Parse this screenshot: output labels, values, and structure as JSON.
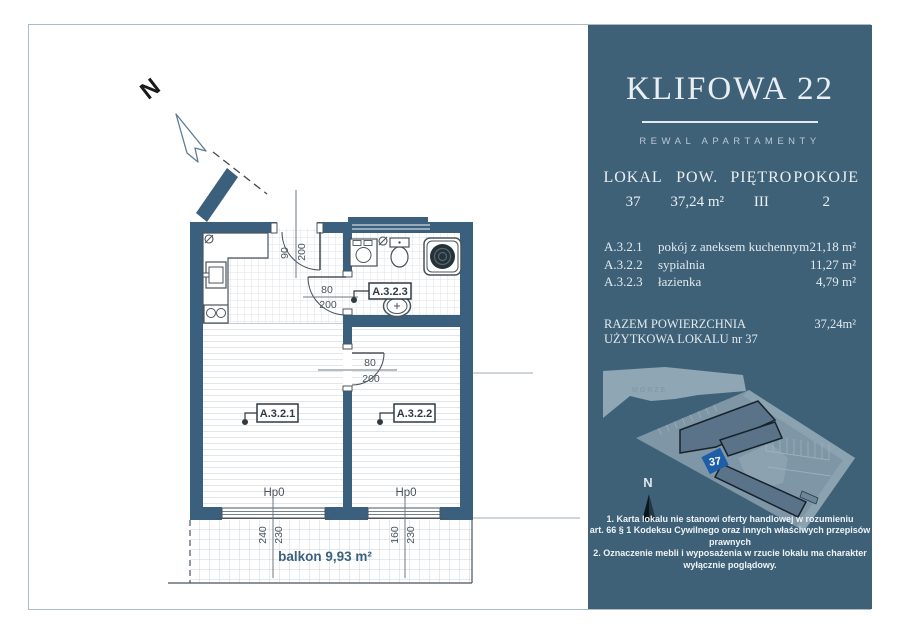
{
  "plan": {
    "north_label": "N",
    "entry_door": {
      "w": "90",
      "h": "200"
    },
    "bathroom_door": {
      "w": "80",
      "h": "200"
    },
    "bedroom_door": {
      "w": "80",
      "h": "200"
    },
    "room_tags": {
      "living": "A.3.2.1",
      "bedroom": "A.3.2.2",
      "bathroom": "A.3.2.3"
    },
    "window_left": {
      "sill": "Hp0",
      "w": "240",
      "h": "230"
    },
    "window_right": {
      "sill": "Hp0",
      "w": "160",
      "h": "230"
    },
    "balcony_label": "balkon 9,93 m²"
  },
  "panel": {
    "title": "KLIFOWA 22",
    "subtitle": "REWAL APARTAMENTY",
    "summary": [
      {
        "label": "LOKAL",
        "value": "37"
      },
      {
        "label": "POW.",
        "value": "37,24 m²"
      },
      {
        "label": "PIĘTRO",
        "value": "III"
      },
      {
        "label": "POKOJE",
        "value": "2"
      }
    ],
    "rooms": [
      {
        "code": "A.3.2.1",
        "name": "pokój z aneksem kuchennym",
        "area": "21,18 m²"
      },
      {
        "code": "A.3.2.2",
        "name": "sypialnia",
        "area": "11,27 m²"
      },
      {
        "code": "A.3.2.3",
        "name": "łazienka",
        "area": "4,79 m²"
      }
    ],
    "total": {
      "label": "RAZEM POWIERZCHNIA UŻYTKOWA LOKALU nr 37",
      "value": "37,24m²"
    },
    "siteplan": {
      "sea_label": "MORZE",
      "unit_marker": "37",
      "north_label": "N"
    },
    "disclaimer": [
      "1. Karta lokalu nie stanowi oferty handlowej w rozumieniu",
      "art. 66 § 1 Kodeksu Cywilnego oraz innych właściwych przepisów prawnych",
      "2. Oznaczenie mebli i wyposażenia w rzucie lokalu ma charakter wyłącznie poglądowy."
    ],
    "colors": {
      "panel_bg": "#3e6178",
      "wall": "#3a607e",
      "marker_blue": "#1e5ea8"
    }
  }
}
